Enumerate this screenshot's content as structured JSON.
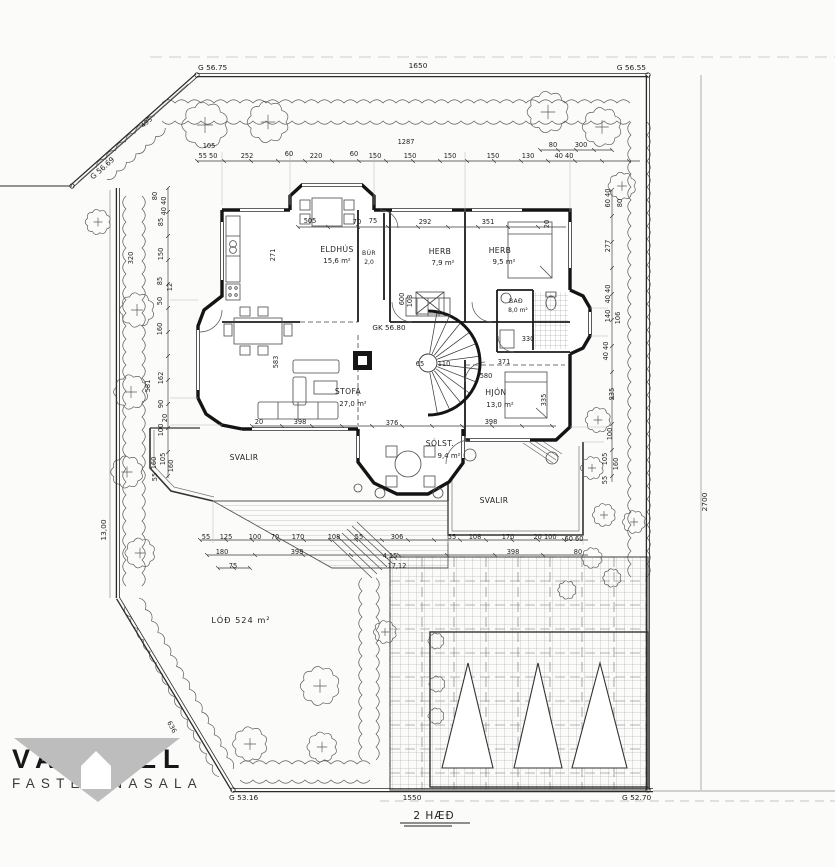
{
  "drawing": {
    "floor_note": "2 HÆÐ",
    "corners": {
      "top_left": "G 56.75",
      "top_right": "G 56.55",
      "upper_left": "G 56.69",
      "bottom_left": "G 53.16",
      "bottom_right": "G 52.70"
    },
    "boundary": {
      "top": "1650",
      "bottom": "1550",
      "left": "13,00",
      "right": "2700",
      "diag_top_left": "495",
      "diag_bottom_left": "636"
    },
    "lot_label": "LÓÐ 524 m²",
    "floor_elevation": "GK 56.80",
    "rooms": [
      {
        "name": "ELDHÚS",
        "area": "15,6 m²"
      },
      {
        "name": "BÚR",
        "area": "2,0"
      },
      {
        "name": "HERB",
        "area": "7,9 m²"
      },
      {
        "name": "HERB",
        "area": "9,5 m²"
      },
      {
        "name": "BAÐ",
        "area": "8,0 m²"
      },
      {
        "name": "STOFA",
        "area": "27,0 m²"
      },
      {
        "name": "HJÓN",
        "area": "13,0 m²"
      },
      {
        "name": "SÓLST.",
        "area": "9,4 m²"
      },
      {
        "name": "SVALIR",
        "area": ""
      },
      {
        "name": "SVALIR",
        "area": ""
      }
    ],
    "dims": {
      "top": [
        "1287",
        "105",
        "55  50",
        "252",
        "60",
        "220",
        "60",
        "150",
        "150",
        "150",
        "150",
        "130",
        "80",
        "300",
        "40 40"
      ],
      "bottom": [
        "55",
        "125",
        "100",
        "70",
        "170",
        "108",
        "55",
        "306",
        "55",
        "108",
        "170",
        "20 100",
        "60 60",
        "180",
        "398",
        "398",
        "80",
        "75",
        "4,15",
        "17,12"
      ],
      "left": [
        "80",
        "40 40",
        "85",
        "320",
        "150",
        "85",
        "12",
        "50",
        "160",
        "581",
        "162",
        "90",
        "20",
        "100",
        "160",
        "105",
        "160",
        "55"
      ],
      "right": [
        "60 40",
        "80",
        "277",
        "40 40",
        "140",
        "106",
        "40 40",
        "235",
        "100",
        "105",
        "160",
        "55"
      ],
      "inner": [
        "505",
        "70",
        "75",
        "292",
        "351",
        "20",
        "271",
        "600",
        "103",
        "583",
        "65",
        "110",
        "580",
        "371",
        "335",
        "398",
        "376",
        "20",
        "398",
        "330"
      ]
    }
  },
  "logo": {
    "name": "VALHÖLL",
    "subtitle": "FASTEIGNASALA"
  }
}
